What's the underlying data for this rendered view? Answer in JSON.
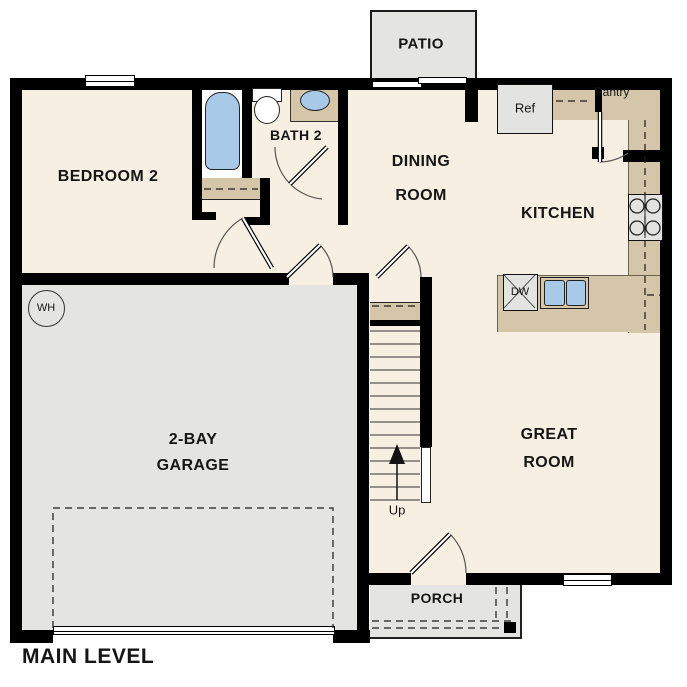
{
  "plan_title": "MAIN LEVEL",
  "rooms": {
    "bedroom2": "BEDROOM 2",
    "bath2": "BATH 2",
    "dining_line1": "DINING",
    "dining_line2": "ROOM",
    "kitchen": "KITCHEN",
    "great_line1": "GREAT",
    "great_line2": "ROOM",
    "garage_line1": "2-BAY",
    "garage_line2": "GARAGE",
    "porch": "PORCH",
    "patio": "PATIO",
    "pantry": "Pantry"
  },
  "fixtures": {
    "refrigerator": "Ref",
    "dishwasher": "DW",
    "water_heater": "WH",
    "stairs_direction": "Up"
  },
  "colors": {
    "floor": "#f7efe2",
    "garage": "#e4e4e2",
    "counter": "#d5c6aa",
    "fixture_blue": "#a9c9e9",
    "appliance": "#e3e3e1",
    "wall": "#000000"
  }
}
